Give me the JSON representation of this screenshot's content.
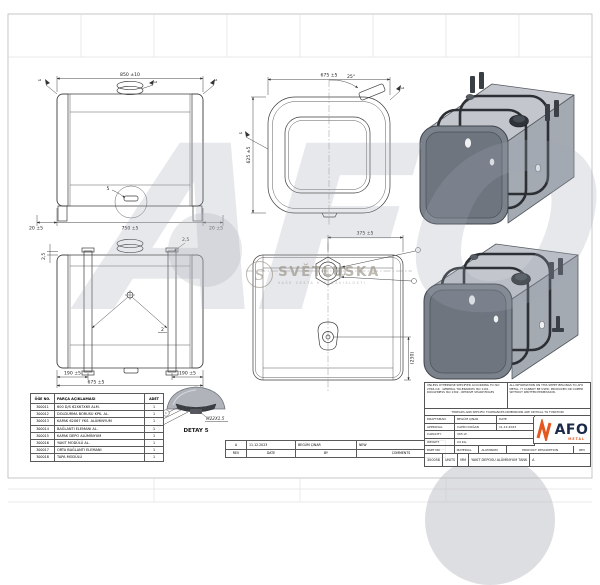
{
  "sheet": {
    "description": "Aluminum fuel tank technical drawing"
  },
  "colors": {
    "accent_orange": "#e4571e",
    "logo_navy": "#1b2a4a",
    "tank_face": "#7b828c",
    "tank_light": "#c3c7cd",
    "strap_dark": "#2c2f34"
  },
  "dims": {
    "a_width": "850 ±10",
    "a_left": "20 ±5",
    "a_center": "750 ±5",
    "a_right": "20 ±5",
    "a_weld_l": "a4",
    "a_weld_r": "a4",
    "a_weld_c": "a4",
    "a_detail_callout": "5",
    "b_width": "675 ±5",
    "b_height": "625 ±5",
    "b_angle": "25°",
    "b_weld_l": "a4",
    "b_weld_r": "a4",
    "d_left": "190 ±5",
    "d_mid": "675 ±5",
    "d_right": "190 ±5",
    "d_top_l": "2,5",
    "d_top_r": "2,5",
    "d_strap_callout": "2",
    "e_top": "375 ±5",
    "e_side": "(230)"
  },
  "detail": {
    "title": "DETAY 5",
    "thread": "M22X1.5",
    "balloons": [
      "1",
      "2",
      "3"
    ]
  },
  "parts_table": {
    "headers": [
      "ÖĞE NO.",
      "PARÇA AÇIKLAMASI",
      "ADET"
    ],
    "rows": [
      {
        "no": "300011",
        "desc": "600 D/S 62X67X65 ALM.",
        "qty": "1"
      },
      {
        "no": "300012",
        "desc": "DOLDURMA BORUSU KPK. AL.",
        "qty": "1"
      },
      {
        "no": "300013",
        "desc": "KAPAK 62X67 YKS. ALÜMİNYUM",
        "qty": "1"
      },
      {
        "no": "300014",
        "desc": "BAĞLANTI ELEMANI AL.",
        "qty": "1"
      },
      {
        "no": "300015",
        "desc": "KAPAK DEPO ALÜMİNYUM",
        "qty": "1"
      },
      {
        "no": "300016",
        "desc": "YAKIT MODÜLÜ AL.",
        "qty": "1"
      },
      {
        "no": "300017",
        "desc": "ORTA BAĞLANTI ELEMANI",
        "qty": "1"
      },
      {
        "no": "300018",
        "desc": "TAPA MODÜLÜ",
        "qty": "1"
      }
    ]
  },
  "title_block": {
    "notes_left": "UNLESS OTHERWISE SPECIFIED ACCORDING TO ISO 2768-mK · GENERAL TOLERANCES ISO 1101 · ROUGHNESS ISO 1302 - REMOVE SHARP EDGES",
    "notes_right": "ALL INFORMATION ON THIS SHEET BELONGS TO AFO METAL. IT CANNOT BE USED, PRODUCED OR COPIED WITHOUT WRITTEN PERMISSION.",
    "critical_note": "THREADS AND SPECIFIC TOLERANCES DIMENSIONS ARE CRITICAL TO FUNCTION",
    "draftsman_label": "DRAFTSMAN",
    "draftsman": "BEGÜM ÇINAR",
    "date_label": "DATE",
    "approval_label": "APPROVAL",
    "approval": "CAHİD DOĞAN",
    "date": "11.12.2023",
    "capacity_label": "CAPACITY",
    "capacity": "305 LT.",
    "weight_label": "WEIGHT",
    "weight": "24 KG.",
    "part_no_label": "PART NO",
    "material_label": "MATERIAL",
    "material": "ALUMINUM",
    "product_label": "PRODUCT DESCRIPTION",
    "rev_label": "REV",
    "part_no": "300058",
    "units_label": "UNITS",
    "units": "MM",
    "product": "YAKIT DEPOSU ALÜMİNYUM TANK",
    "rev": "A",
    "logo_text": "AFO",
    "logo_sub": "METAL"
  },
  "revision_table": {
    "headers": [
      "REV",
      "DATE",
      "BY",
      "COMMENTS"
    ],
    "row": {
      "rev": "A",
      "date": "11.12.2023",
      "by": "BEGÜM ÇINAR",
      "comment": "NEW"
    }
  },
  "watermarks": {
    "big_logo": "AFO",
    "brand_initial": "S",
    "brand": "SVĚTLUSKA",
    "tagline": "VAŠE CESTA K NEZÁVISLOSTI"
  }
}
